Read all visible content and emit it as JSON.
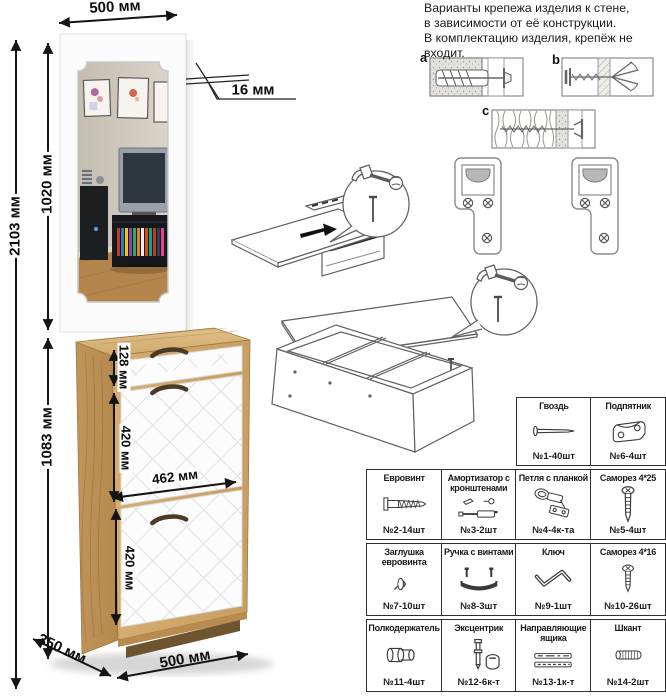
{
  "dims": {
    "top_width": "500 мм",
    "total_height": "2103 мм",
    "mirror_height": "1020 мм",
    "cabinet_height": "1083 мм",
    "thickness": "16 мм",
    "drawer_height": "128 мм",
    "flap_height_1": "420 мм",
    "front_width": "462 мм",
    "flap_height_2": "420 мм",
    "depth": "350 мм",
    "bottom_width": "500 мм"
  },
  "note": {
    "line1": "Варианты крепежа изделия к стене,",
    "line2": "в зависимости от её конструкции.",
    "line3": "В комплектацию изделия, крепёж не",
    "line4": "входит."
  },
  "fastener_variants": {
    "a": "a",
    "b": "b",
    "c": "c"
  },
  "parts": [
    {
      "name": "Гвоздь",
      "qty": "№1-40шт",
      "icon": "nail-icon"
    },
    {
      "name": "Подпятник",
      "qty": "№6-4шт",
      "icon": "glide-icon"
    },
    {
      "name": "Евровинт",
      "qty": "№2-14шт",
      "icon": "confirmat-icon"
    },
    {
      "name": "Амортизатор с кронштенами",
      "qty": "№3-2шт",
      "icon": "gas-strut-icon"
    },
    {
      "name": "Петля с планкой",
      "qty": "№4-4к-та",
      "icon": "hinge-icon"
    },
    {
      "name": "Саморез 4*25",
      "qty": "№5-4шт",
      "icon": "screw-icon"
    },
    {
      "name": "Заглушка евровинта",
      "qty": "№7-10шт",
      "icon": "cap-icon"
    },
    {
      "name": "Ручка с винтами",
      "qty": "№8-3шт",
      "icon": "handle-icon"
    },
    {
      "name": "Ключ",
      "qty": "№9-1шт",
      "icon": "hex-key-icon"
    },
    {
      "name": "Саморез 4*16",
      "qty": "№10-26шт",
      "icon": "screw-icon"
    },
    {
      "name": "Полкодержатель",
      "qty": "№11-4шт",
      "icon": "shelf-pin-icon"
    },
    {
      "name": "Эксцентрик",
      "qty": "№12-6к-т",
      "icon": "cam-lock-icon"
    },
    {
      "name": "Направляющие ящика",
      "qty": "№13-1к-т",
      "icon": "drawer-slides-icon"
    },
    {
      "name": "Шкант",
      "qty": "№14-2шт",
      "icon": "dowel-icon"
    }
  ],
  "colors": {
    "wood": "#cfa76b",
    "wood_dark": "#b88c4f",
    "front_white": "#fcfcfc",
    "line": "#111111",
    "mirror_wall": "#cdc6ba",
    "mirror_floor": "#b5854e"
  }
}
